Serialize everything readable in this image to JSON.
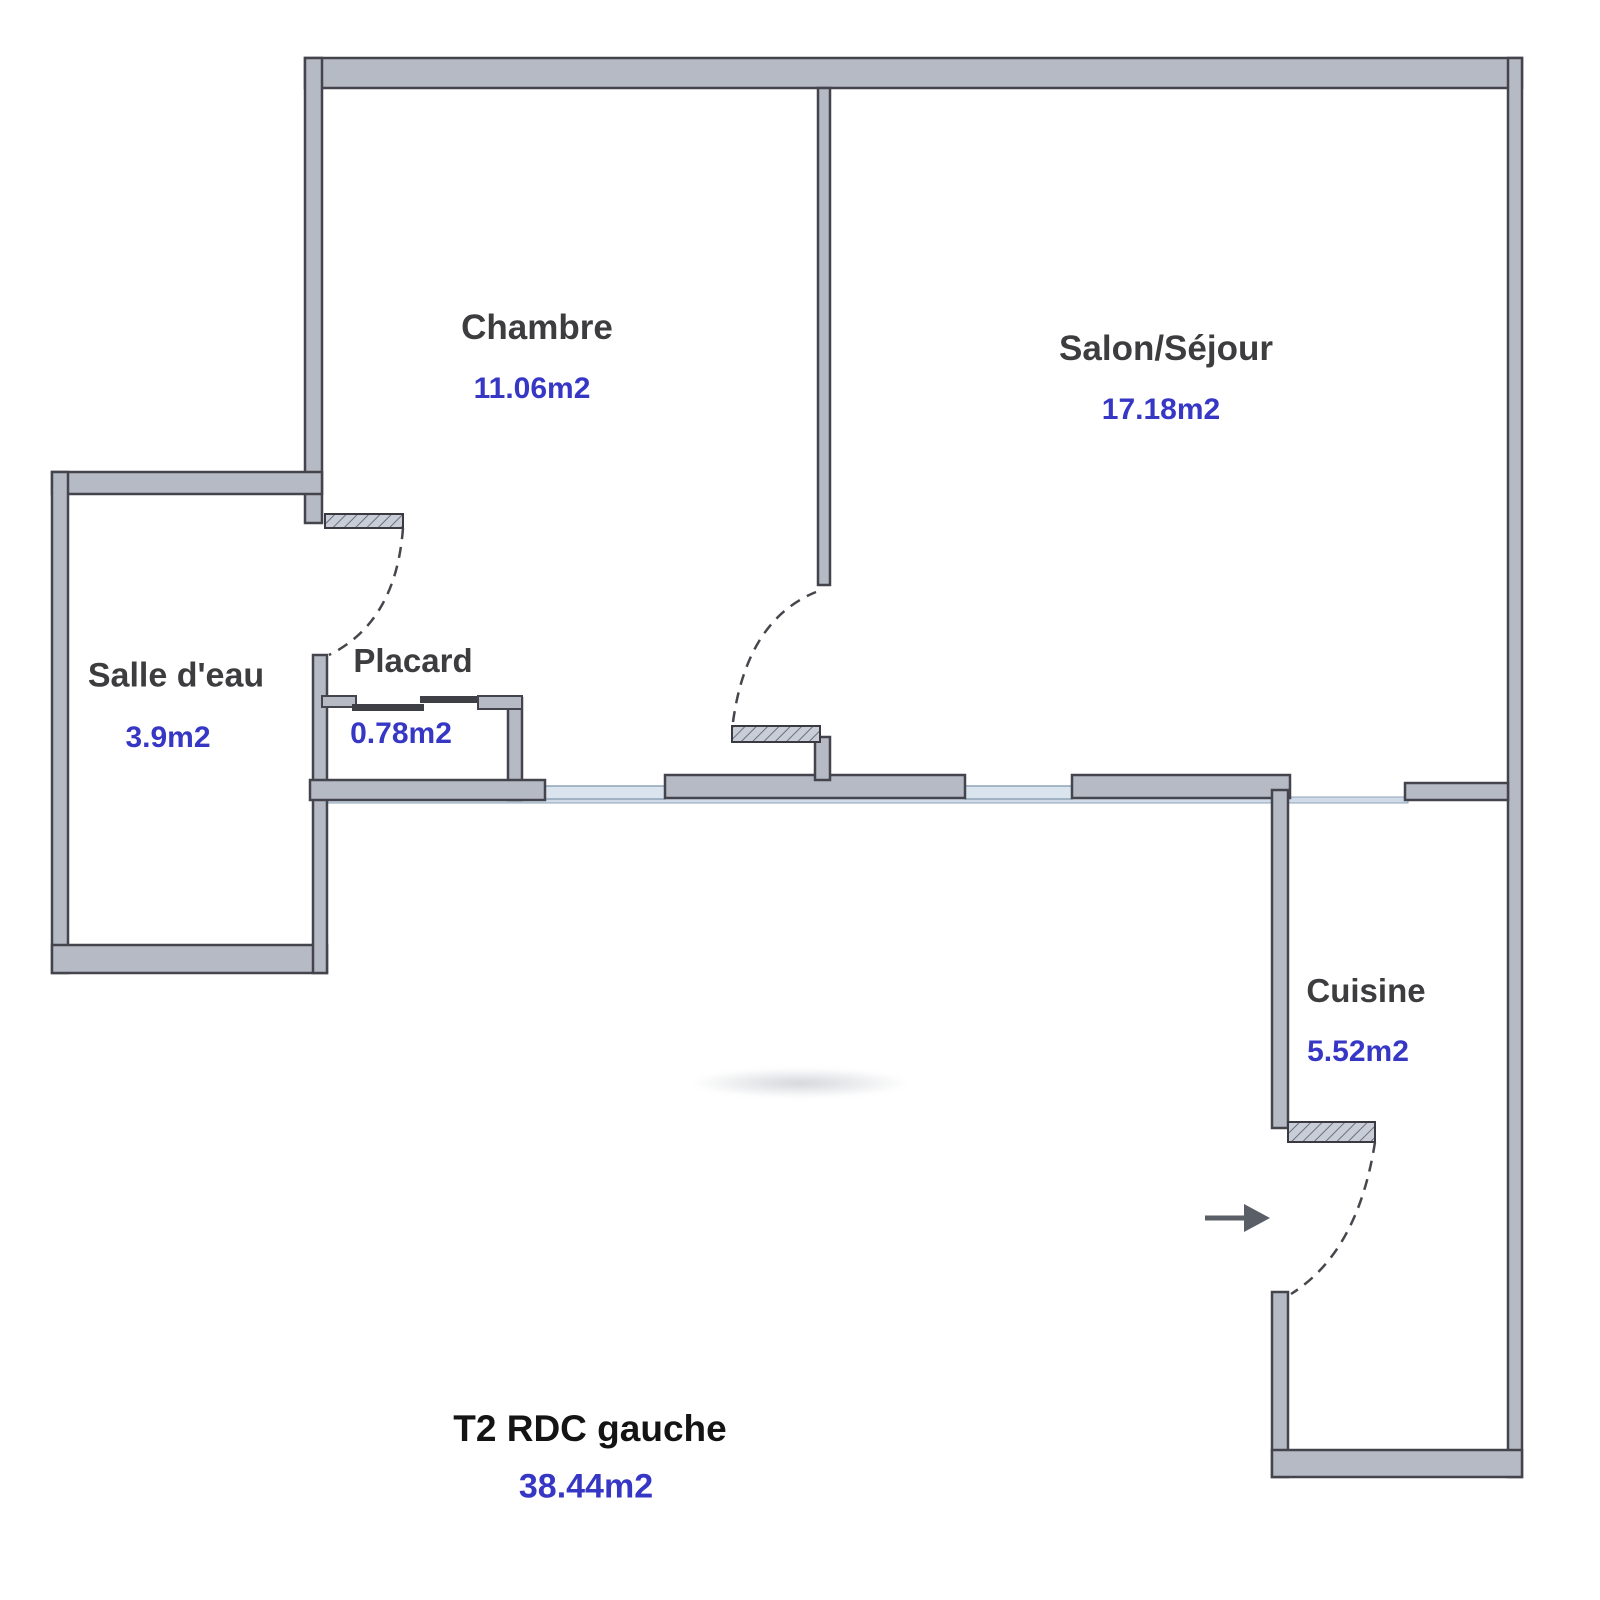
{
  "plan": {
    "title": "T2 RDC gauche",
    "total_area": "38.44m2"
  },
  "rooms": {
    "chambre": {
      "label": "Chambre",
      "area": "11.06m2"
    },
    "salon": {
      "label": "Salon/Séjour",
      "area": "17.18m2"
    },
    "salle_eau": {
      "label": "Salle d'eau",
      "area": "3.9m2"
    },
    "placard": {
      "label": "Placard",
      "area": "0.78m2"
    },
    "cuisine": {
      "label": "Cuisine",
      "area": "5.52m2"
    }
  },
  "icons": {
    "entrance_arrow": "right-arrow"
  },
  "colors": {
    "wall_fill": "#b6bac5",
    "wall_edge": "#44444c",
    "window_fill": "#d9e4ef",
    "window_edge": "#8fa3b6",
    "room_label": "#3d3d3f",
    "area_label": "#3737c6"
  }
}
